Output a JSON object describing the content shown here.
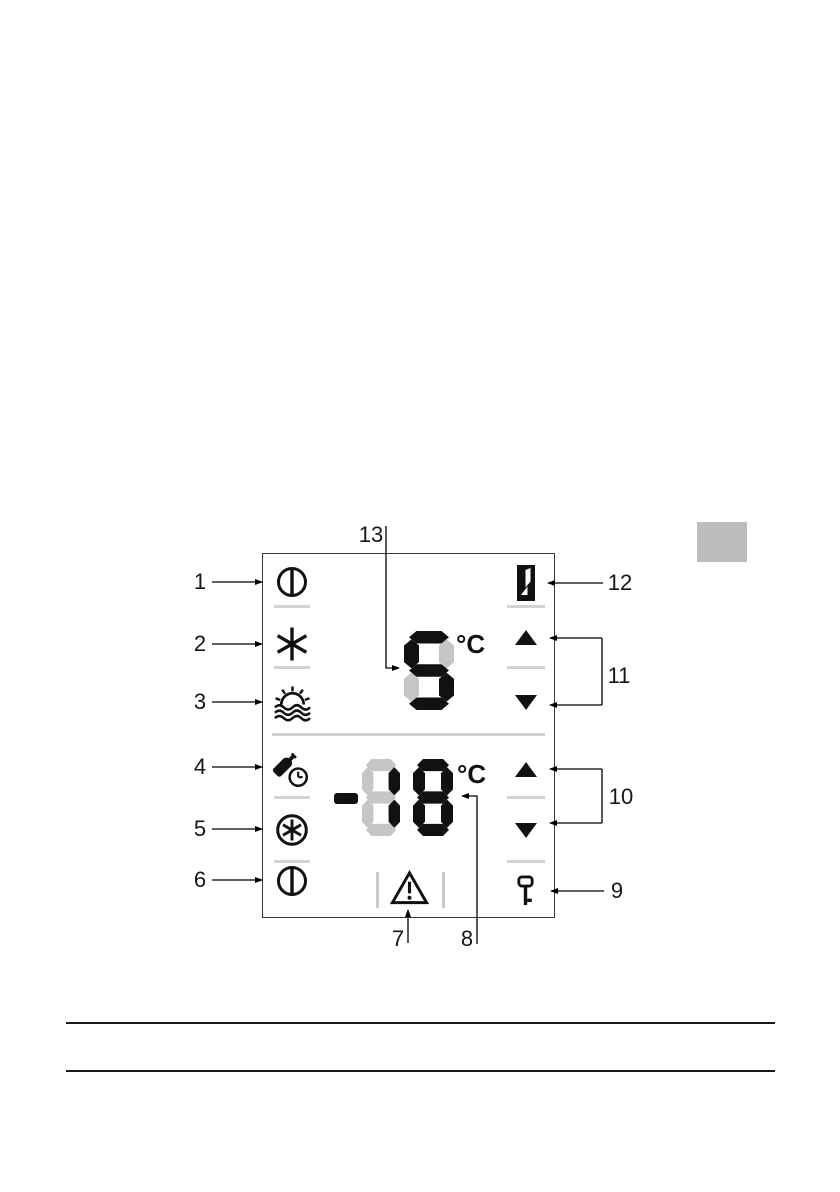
{
  "page": {
    "background": "#ffffff"
  },
  "margin_marker": {
    "color": "#bdbdbd"
  },
  "diagram": {
    "title": "appliance-control-panel",
    "border_color": "#3a3a3a",
    "divider_color": "#cfcfcf",
    "separator_color": "#d2d2d2",
    "display": {
      "on_color": "#111111",
      "ghost_color": "#c6c6c6",
      "fridge": {
        "value": "5",
        "unit": "°C"
      },
      "freezer": {
        "value": "-18",
        "unit": "°C"
      }
    },
    "icons": {
      "left_column": [
        "fridge-power-icon",
        "supercool-icon",
        "holiday-icon",
        "bottle-timer-icon",
        "superfrost-icon",
        "freezer-power-icon"
      ],
      "right_column": [
        "door-open-icon",
        "fridge-temp-up-icon",
        "fridge-temp-down-icon",
        "freezer-temp-up-icon",
        "freezer-temp-down-icon",
        "key-lock-icon"
      ],
      "bottom": [
        "alarm-icon"
      ]
    }
  },
  "callouts": [
    {
      "num": "1"
    },
    {
      "num": "2"
    },
    {
      "num": "3"
    },
    {
      "num": "4"
    },
    {
      "num": "5"
    },
    {
      "num": "6"
    },
    {
      "num": "7"
    },
    {
      "num": "8"
    },
    {
      "num": "9"
    },
    {
      "num": "10"
    },
    {
      "num": "11"
    },
    {
      "num": "12"
    },
    {
      "num": "13"
    }
  ]
}
